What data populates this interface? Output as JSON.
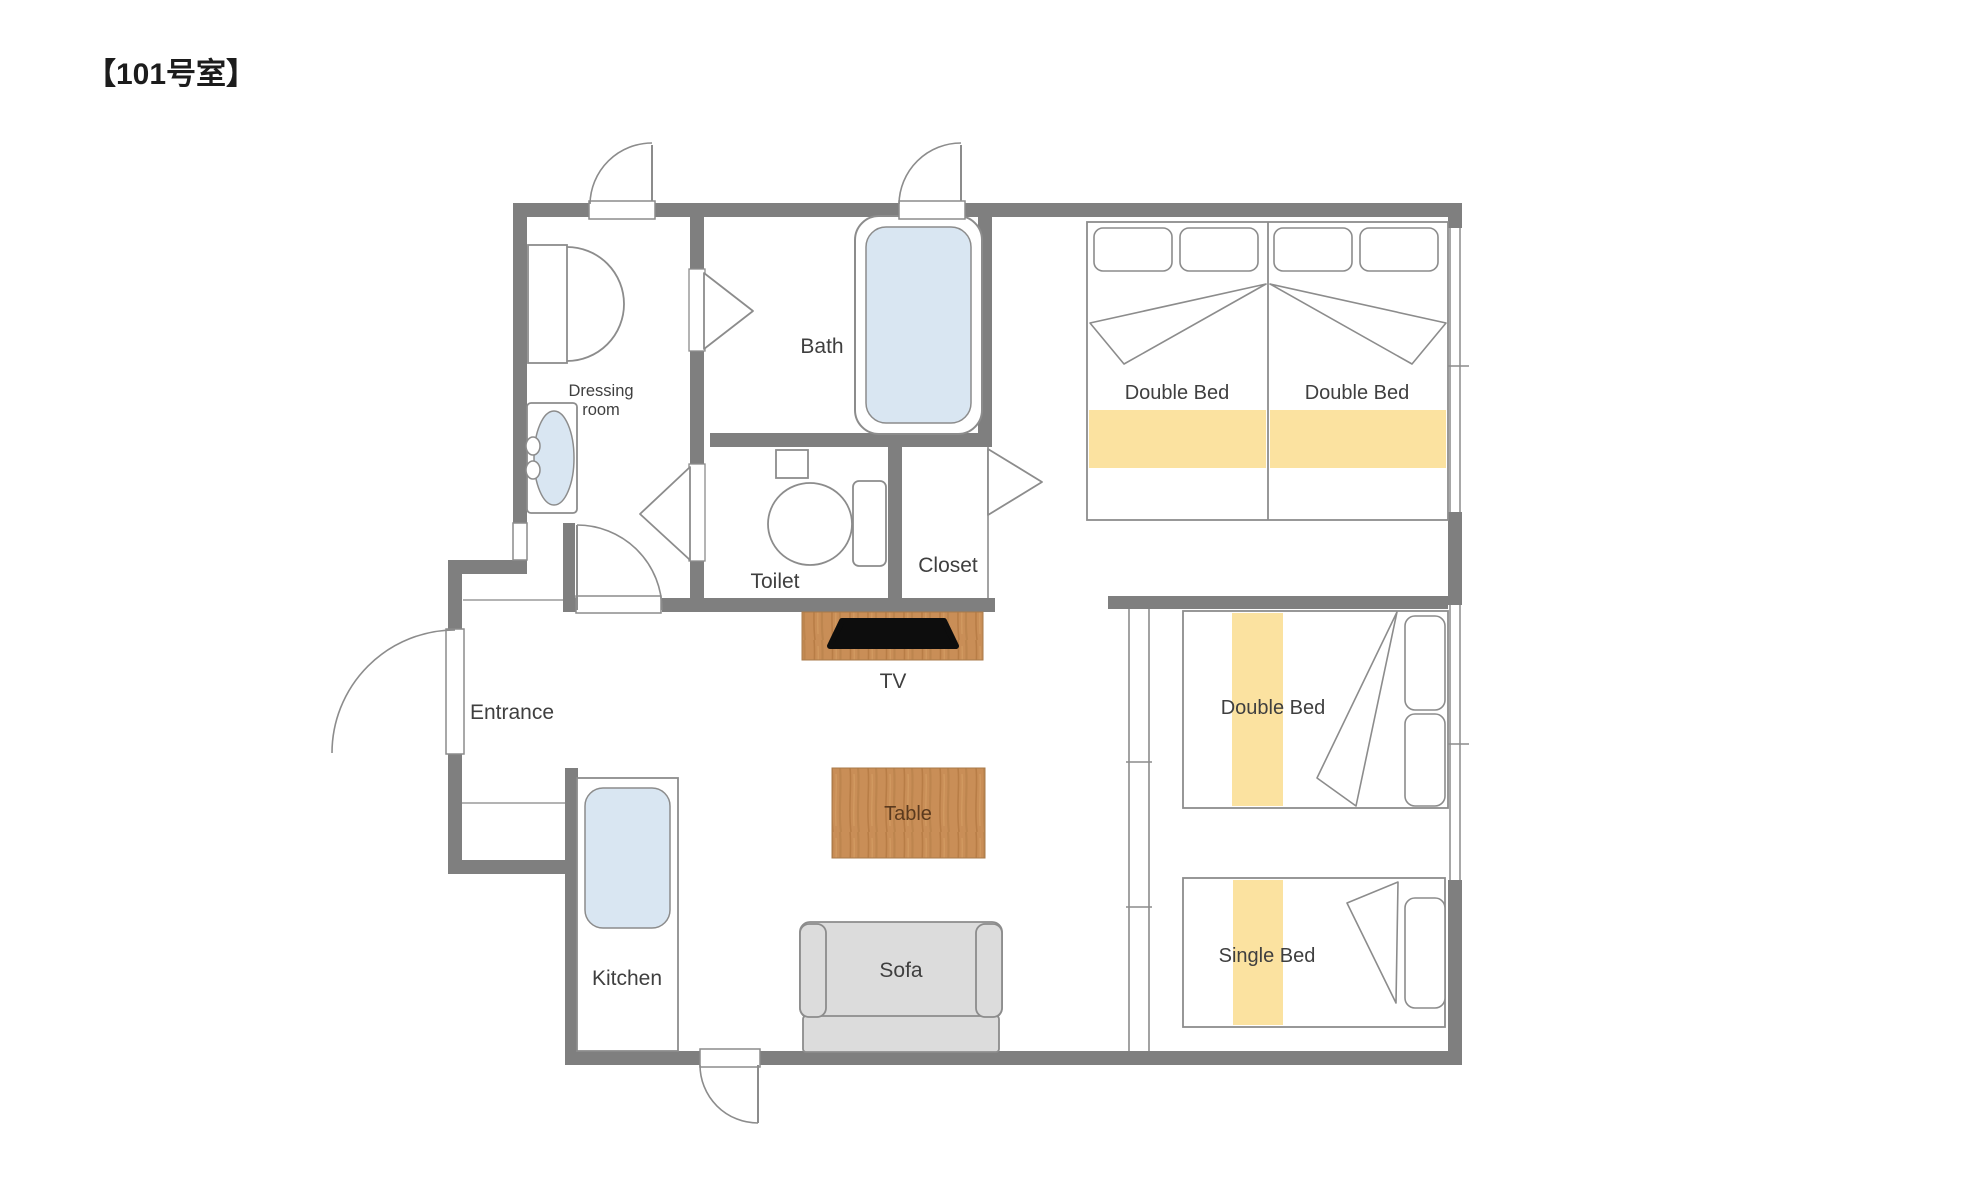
{
  "title": "【101号室】",
  "colors": {
    "wall": "#7f7f7f",
    "line": "#8c8c8c",
    "water": "#d9e6f2",
    "bed_accent": "#fbe2a0",
    "wood_base": "#c98e57",
    "wood_grain": "#a96f39",
    "sofa_gray": "#dcdcdc",
    "tv_black": "#0d0d0d"
  },
  "rooms": {
    "dressing_room": {
      "label_line1": "Dressing",
      "label_line2": "room"
    },
    "bath": {
      "label": "Bath"
    },
    "toilet": {
      "label": "Toilet"
    },
    "closet": {
      "label": "Closet"
    },
    "entrance": {
      "label": "Entrance"
    },
    "kitchen": {
      "label": "Kitchen"
    }
  },
  "furniture": {
    "tv": {
      "label": "TV"
    },
    "table": {
      "label": "Table"
    },
    "sofa": {
      "label": "Sofa"
    },
    "double_bed_top_left": {
      "label": "Double Bed"
    },
    "double_bed_top_right": {
      "label": "Double Bed"
    },
    "double_bed_lower": {
      "label": "Double Bed"
    },
    "single_bed": {
      "label": "Single Bed"
    }
  }
}
